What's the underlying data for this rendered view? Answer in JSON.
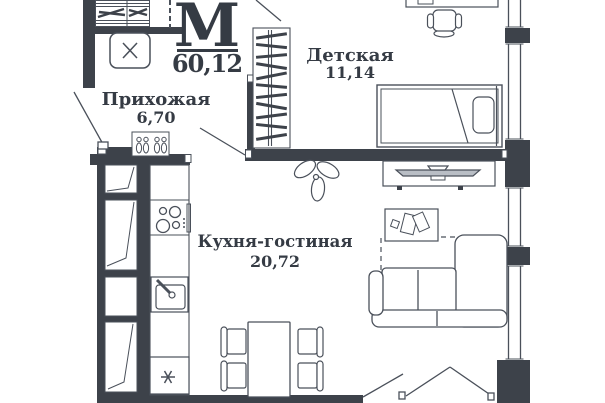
{
  "plan": {
    "logo": {
      "letter": "М",
      "total_area": "60,12"
    },
    "rooms": [
      {
        "name": "Прихожая",
        "area": "6,70"
      },
      {
        "name": "Детская",
        "area": "11,14"
      },
      {
        "name": "Кухня-гостиная",
        "area": "20,72"
      }
    ],
    "furniture": [
      "hanger-closet",
      "washing-machine",
      "shoe-rack",
      "wardrobe",
      "desk",
      "office-chair",
      "single-bed",
      "tv-stand",
      "plant",
      "coffee-table",
      "corner-sofa",
      "dining-table",
      "dining-chairs",
      "cooktop",
      "kitchen-sink",
      "refrigerator"
    ],
    "colors": {
      "wall": "#3d424a",
      "line": "#4a505a",
      "background": "#ffffff",
      "text": "#353b44"
    }
  }
}
